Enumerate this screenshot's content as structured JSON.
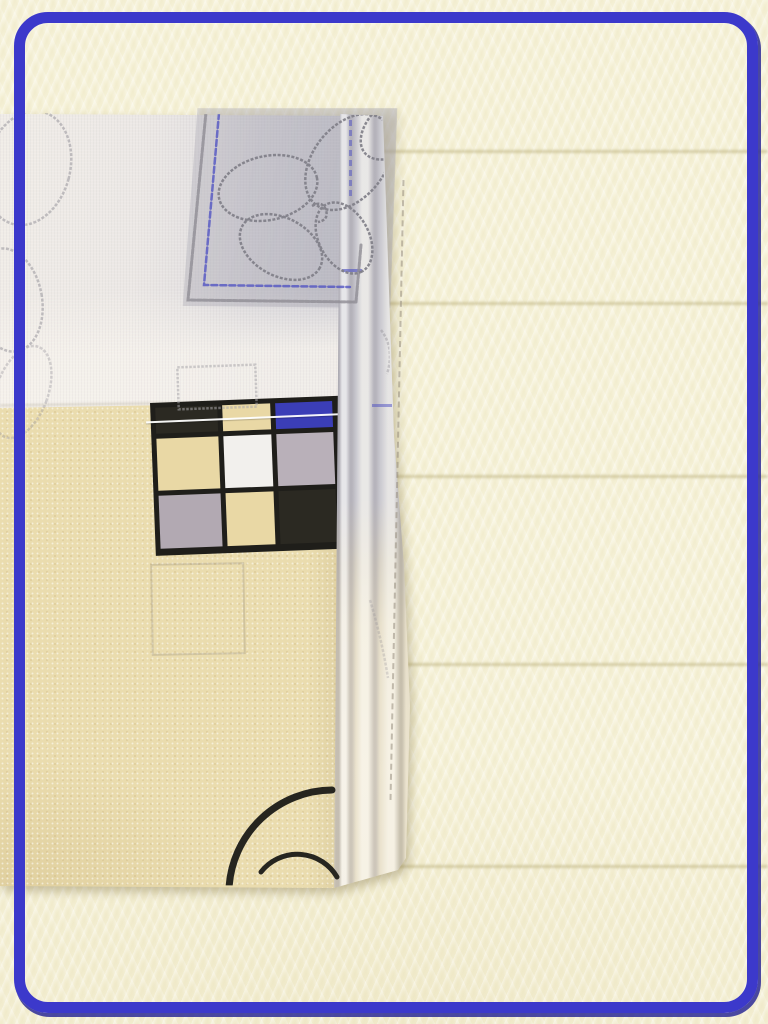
{
  "scene": {
    "type": "product-photo",
    "description": "Folded printed bed linen lying on a cream fleece blanket, framed by a rounded indigo border; no text is visible in the image",
    "frame": {
      "color": "#3c39cb",
      "shadow_color": "#2b2a96",
      "corner_radius_px": 34,
      "thickness_px": 11
    },
    "background": {
      "fleece_color": "#f6f2d9",
      "groove_color": "#b9ae79",
      "groove_positions_y": [
        150,
        302,
        475,
        663,
        865
      ]
    }
  },
  "fabric": {
    "panels": {
      "top": {
        "name": "gray printed panel with sketched flowers",
        "base_color": "#ece8e5",
        "print_patch_color": "#c9c8d0"
      },
      "bottom": {
        "name": "beige speckled panel",
        "base_color": "#eadcae"
      },
      "fold": {
        "name": "folded hem edge strips",
        "gray_color": "#c9c8cf",
        "cream_color": "#ebe3ce"
      }
    },
    "print": {
      "flower_outline_color": "#7f7e87",
      "frame_outline_color": "#8e8c94",
      "frame_inner_line_color": "#4a4cc2",
      "faint_square_color": "#a9a7ab",
      "swirl_arc_color": "#26251f",
      "blue_mark_color": "#4a4cc2"
    },
    "checkerboard": {
      "grid_color": "#1f1e1a",
      "stitch_color": "#ffffff",
      "rows": [
        [
          "#2b2922",
          "#e9d8a5",
          "#3b3eb7"
        ],
        [
          "#e9d8a5",
          "#f2f0ed",
          "#b9b0b9"
        ],
        [
          "#b2a9b2",
          "#e9d8a5",
          "#2b2922"
        ]
      ]
    }
  }
}
